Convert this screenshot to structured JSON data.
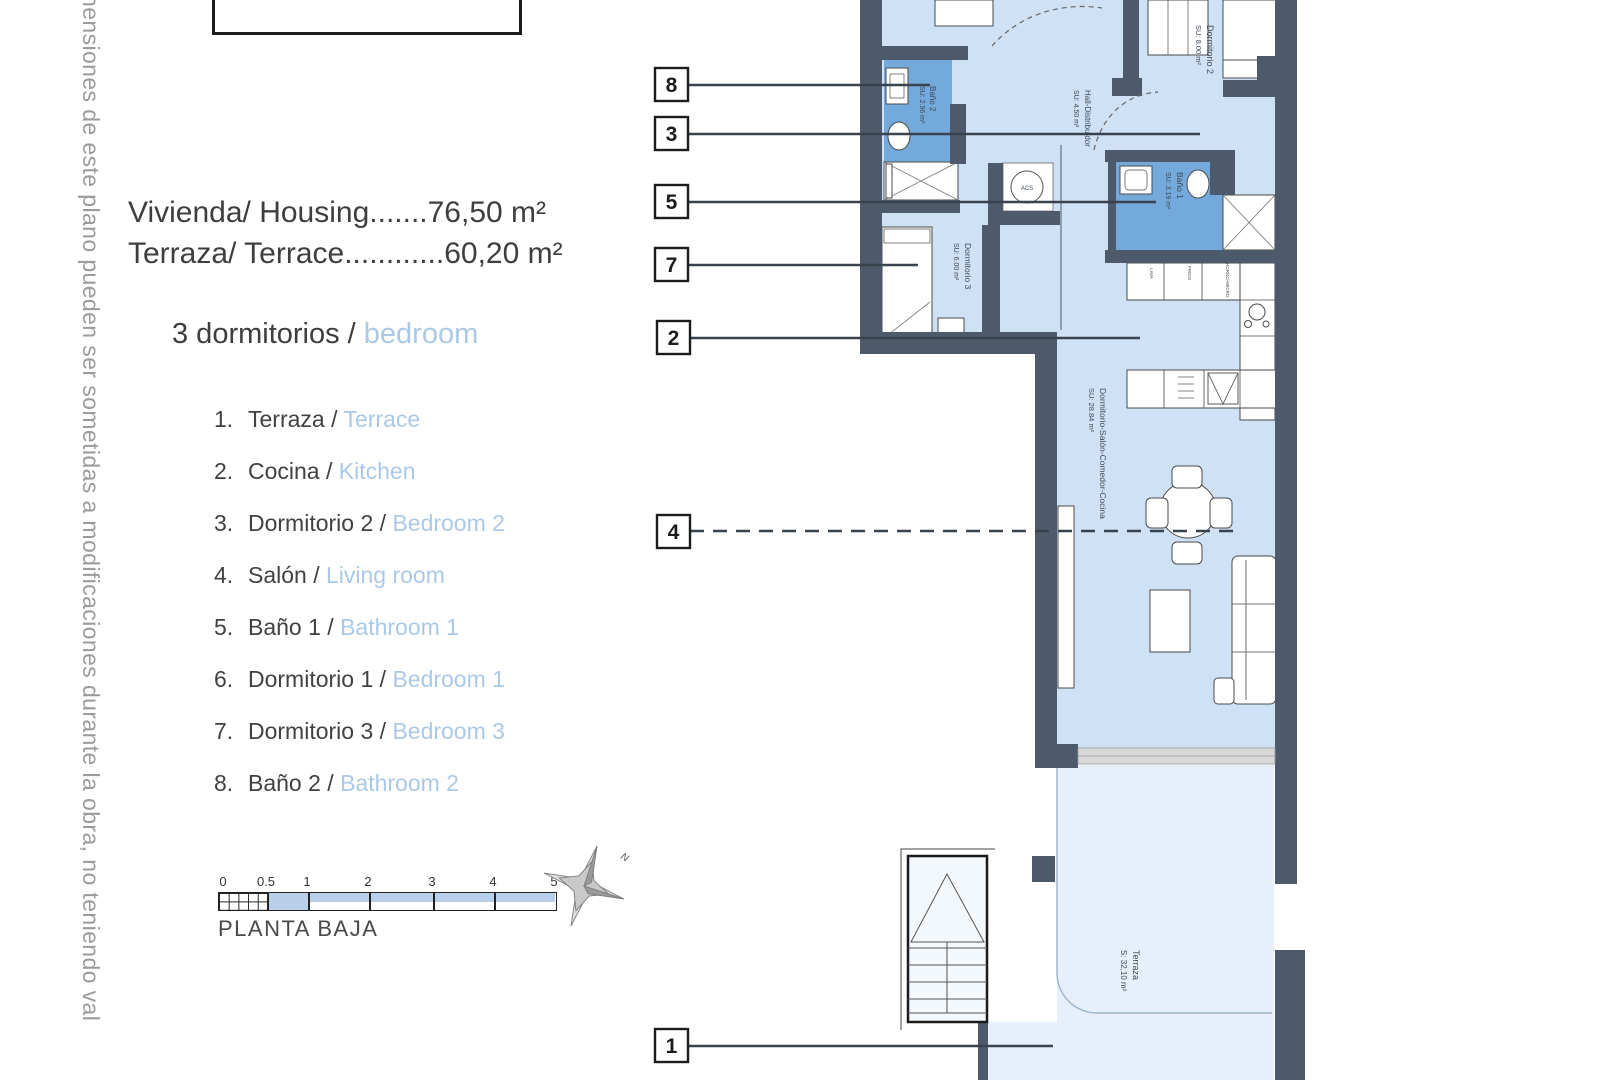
{
  "theme": {
    "wall": "#4d5a6b",
    "floor": "#cfe1f5",
    "bath": "#74a9dc",
    "terrace": "#e7f0fa",
    "accentblue": "#abc9e7",
    "scaleblue": "#b9cfe9",
    "textdark": "#3d3e40",
    "gray": "#9b9b9b",
    "line": "#39434f"
  },
  "disclaimer": {
    "text": "nensiones de este plano pueden ser sometidas a modificaciones durante la obra, no teniendo val"
  },
  "title_block": {
    "text": "BAJO B"
  },
  "specs": {
    "housing": "Vivienda/ Housing.......76,50 m²",
    "terrace": "Terraza/ Terrace............60,20 m²"
  },
  "bedrooms_line": {
    "es": "3 dormitorios / ",
    "en": "bedroom"
  },
  "legend": {
    "items": [
      {
        "num": "1.",
        "es": "Terraza / ",
        "en": "Terrace"
      },
      {
        "num": "2.",
        "es": "Cocina / ",
        "en": "Kitchen"
      },
      {
        "num": "3.",
        "es": "Dormitorio 2 / ",
        "en": "Bedroom 2"
      },
      {
        "num": "4.",
        "es": "Salón / ",
        "en": "Living room"
      },
      {
        "num": "5.",
        "es": "Baño 1 / ",
        "en": "Bathroom 1"
      },
      {
        "num": "6.",
        "es": "Dormitorio 1 / ",
        "en": "Bedroom 1"
      },
      {
        "num": "7.",
        "es": "Dormitorio 3 / ",
        "en": "Bedroom 3"
      },
      {
        "num": "8.",
        "es": "Baño 2 / ",
        "en": "Bathroom 2"
      }
    ]
  },
  "scale_bar": {
    "ticks": [
      "0",
      "0.5",
      "1",
      "2",
      "3",
      "4",
      "5"
    ],
    "caption": "PLANTA BAJA"
  },
  "compass": {
    "north": "N"
  },
  "plan": {
    "callouts": [
      {
        "num": "8"
      },
      {
        "num": "3"
      },
      {
        "num": "5"
      },
      {
        "num": "7"
      },
      {
        "num": "2"
      },
      {
        "num": "4"
      },
      {
        "num": "1"
      }
    ],
    "rooms": {
      "bano2": {
        "name": "Baño 2",
        "area": "SU: 2.96 m²"
      },
      "hall": {
        "name": "Hall-Distribuidor",
        "area": "SU: 4.50 m²"
      },
      "dormitorio2": {
        "name": "Dormitorio 2",
        "area": "SU: 8.00 m²"
      },
      "bano1": {
        "name": "Baño 1",
        "area": "SU: 3.19 m²"
      },
      "dormitorio3": {
        "name": "Dormitorio 3",
        "area": "SU: 6.00 m²"
      },
      "salon": {
        "name": "Dormitorio-Salón-Comedor-Cocina",
        "area": "SU: 28.84 m²"
      },
      "terraza": {
        "name": "Terraza",
        "area": "S: 32,10 m²"
      },
      "acs": "ACS",
      "appliances": [
        "LAVA",
        "FRIGO",
        "HORNO+MICRO"
      ]
    }
  }
}
